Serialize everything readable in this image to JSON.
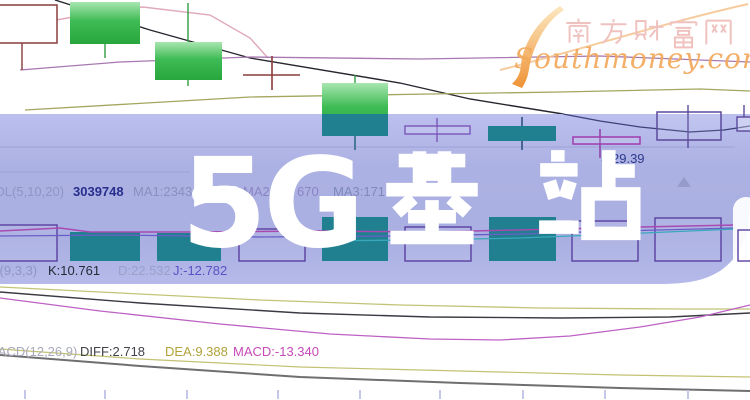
{
  "page": {
    "width": 750,
    "height": 400
  },
  "watermark": {
    "title_prefix": "5G",
    "title_cjk": "基站",
    "full_title": "5G基站"
  },
  "logo": {
    "site_name": "南方财富网",
    "site_url": "Southmoney.com",
    "swoosh_icon": "s-swoosh"
  },
  "indicator_rows": {
    "volume": {
      "label": "VOL(5,10,20)",
      "value": "3039748",
      "ma1": "MA1:2343",
      "ma2": "MA2:2",
      "ma2_cont": "670",
      "ma3": "MA3:171",
      "ma3_cont": "4"
    },
    "kdj": {
      "label": "KDJ(9,3,3)",
      "k": "K:10.761",
      "d": "D:22.532",
      "j": "J:-12.782"
    },
    "macd": {
      "label": "MACD(12,26,9)",
      "diff": "DIFF:2.718",
      "dea": "DEA:9.388",
      "macd": "MACD:-13.340"
    }
  },
  "annotation": {
    "arrow_icon": "←",
    "price": "29.39"
  },
  "colors": {
    "band": "#a9aee2",
    "candle_green": "#2fae44",
    "candle_teal": "#20808f",
    "hollow_purple": "#5a3fa0",
    "maroon": "#8a3c3c",
    "magenta_value": "#c74ab8",
    "dea_olive": "#b2a33c",
    "navy_text": "#272e8c",
    "logo_pink": "#f0c2bf",
    "logo_orange": "#f2a95c"
  },
  "chart_data": {
    "type": "candlestick",
    "title": "5G基站 (watermark over stock K-line chart)",
    "panes": [
      "price with MA lines",
      "volume",
      "KDJ",
      "MACD"
    ],
    "legend": [
      "VOL(5,10,20)",
      "MA1",
      "MA2",
      "MA3",
      "KDJ(9,3,3)",
      "MACD(12,26,9)"
    ],
    "readable_values": {
      "volume": 3039748,
      "MA1": 2343,
      "K": 10.761,
      "D": 22.532,
      "J": -12.782,
      "DIFF": 2.718,
      "DEA": 9.388,
      "MACD": -13.34,
      "price_annotation": 29.39
    },
    "candles_qualitative": [
      {
        "pos": 1,
        "style": "hollow-maroon"
      },
      {
        "pos": 2,
        "style": "solid-green"
      },
      {
        "pos": 3,
        "style": "solid-green"
      },
      {
        "pos": 4,
        "style": "doji-cross-maroon"
      },
      {
        "pos": 5,
        "style": "solid-green"
      },
      {
        "pos": 6,
        "style": "doji-purple"
      },
      {
        "pos": 7,
        "style": "solid-green-under-band"
      },
      {
        "pos": 8,
        "style": "doji-magenta",
        "close": 29.39
      },
      {
        "pos": 9,
        "style": "hollow-purple"
      },
      {
        "pos": 10,
        "style": "hollow-purple-partial"
      }
    ],
    "render": {
      "ops": [
        {
          "op": "poly",
          "name": "price-line-dark",
          "c": "#26262e",
          "w": 1.4,
          "pts": [
            [
              55,
              0
            ],
            [
              150,
              30
            ],
            [
              250,
              58
            ],
            [
              400,
              83
            ],
            [
              470,
              99
            ],
            [
              563,
              114
            ]
          ]
        },
        {
          "op": "poly",
          "name": "ma-line-pink",
          "c": "#e0a8bc",
          "w": 1.4,
          "pts": [
            [
              0,
              30
            ],
            [
              90,
              14
            ],
            [
              143,
              7
            ],
            [
              210,
              15
            ],
            [
              250,
              38
            ],
            [
              268,
              58
            ]
          ]
        },
        {
          "op": "poly",
          "name": "ma-line-purple",
          "c": "#a878b0",
          "w": 1.3,
          "pts": [
            [
              20,
              70
            ],
            [
              120,
              62
            ],
            [
              250,
              57
            ],
            [
              420,
              59
            ],
            [
              600,
              56
            ],
            [
              750,
              62
            ]
          ]
        },
        {
          "op": "poly",
          "name": "ma-line-olive",
          "c": "#a2a65e",
          "w": 1.3,
          "pts": [
            [
              25,
              110
            ],
            [
              250,
              97
            ],
            [
              430,
              94
            ],
            [
              560,
              92
            ],
            [
              700,
              89
            ],
            [
              750,
              91
            ]
          ]
        },
        {
          "op": "rect",
          "name": "candle-hollow",
          "x": -12,
          "y": 5,
          "wd": 69,
          "ht": 38,
          "s": "#8a3c3c",
          "w": 1.5,
          "f": "#ffffff"
        },
        {
          "op": "line",
          "name": "candle-wick",
          "x1": 22,
          "y1": 43,
          "x2": 22,
          "y2": 70,
          "c": "#8a3c3c",
          "w": 1.4
        },
        {
          "op": "rect",
          "name": "candle-green",
          "x": 70,
          "y": 2,
          "wd": 70,
          "ht": 42,
          "f": "url(#greenGrad)"
        },
        {
          "op": "line",
          "name": "candle-wick",
          "x1": 105,
          "y1": 44,
          "x2": 105,
          "y2": 58,
          "c": "#2f9c42",
          "w": 1.4
        },
        {
          "op": "rect",
          "name": "candle-green",
          "x": 155,
          "y": 42,
          "wd": 67,
          "ht": 38,
          "f": "url(#greenGrad)"
        },
        {
          "op": "line",
          "name": "candle-wick",
          "x1": 188,
          "y1": 3,
          "x2": 188,
          "y2": 42,
          "c": "#2f9c42",
          "w": 1.4
        },
        {
          "op": "line",
          "name": "candle-wick",
          "x1": 188,
          "y1": 80,
          "x2": 188,
          "y2": 86,
          "c": "#2f9c42",
          "w": 1.4
        },
        {
          "op": "line",
          "name": "doji-cross-v",
          "x1": 272,
          "y1": 56,
          "x2": 272,
          "y2": 90,
          "c": "#8a3c3c",
          "w": 1.6
        },
        {
          "op": "line",
          "name": "doji-cross-h",
          "x1": 243,
          "y1": 75,
          "x2": 300,
          "y2": 75,
          "c": "#8a3c3c",
          "w": 1.6
        },
        {
          "op": "rect",
          "name": "candle-green",
          "x": 322,
          "y": 83,
          "wd": 66,
          "ht": 53,
          "f": "url(#greenGrad)"
        },
        {
          "op": "line",
          "name": "candle-wick",
          "x1": 355,
          "y1": 75,
          "x2": 355,
          "y2": 83,
          "c": "#2f9c42",
          "w": 1.4
        },
        {
          "op": "path",
          "name": "watermark-band",
          "d": "M-10,114 L750,114 L750,198 C750,232 744,254 720,271 C704,281 686,284 658,284 L-10,284 Z",
          "f": "url(#bandGrad)",
          "o": 0.96
        },
        {
          "op": "poly",
          "name": "grid-line",
          "c": "#9aa0d2",
          "w": 1,
          "o": 0.9,
          "pts": [
            [
              0,
              147
            ],
            [
              735,
              147
            ]
          ]
        },
        {
          "op": "poly",
          "name": "grid-line",
          "c": "#9aa0d2",
          "w": 1,
          "o": 0.8,
          "pts": [
            [
              0,
              172
            ],
            [
              190,
              172
            ]
          ]
        },
        {
          "op": "poly",
          "name": "price-line-in-band",
          "c": "#3a4278",
          "w": 1.3,
          "pts": [
            [
              563,
              114
            ],
            [
              600,
              121
            ],
            [
              640,
              127
            ],
            [
              690,
              132
            ],
            [
              724,
              130
            ],
            [
              750,
              126
            ]
          ]
        },
        {
          "op": "rect",
          "name": "volume-bar-hollow",
          "x": -8,
          "y": 225,
          "wd": 65,
          "ht": 36,
          "s": "#5a3fa0",
          "w": 1.4,
          "f": "rgba(255,255,255,0.07)"
        },
        {
          "op": "rect",
          "name": "volume-bar",
          "x": 70,
          "y": 232,
          "wd": 70,
          "ht": 29,
          "f": "#20808f"
        },
        {
          "op": "rect",
          "name": "volume-bar",
          "x": 157,
          "y": 233,
          "wd": 64,
          "ht": 28,
          "f": "#20808f"
        },
        {
          "op": "rect",
          "name": "volume-bar-hollow",
          "x": 239,
          "y": 229,
          "wd": 66,
          "ht": 32,
          "s": "#5a3fa0",
          "w": 1.4,
          "f": "rgba(255,255,255,0.07)"
        },
        {
          "op": "rect",
          "name": "volume-bar",
          "x": 322,
          "y": 217,
          "wd": 66,
          "ht": 44,
          "f": "#20808f"
        },
        {
          "op": "rect",
          "name": "volume-bar-hollow",
          "x": 405,
          "y": 227,
          "wd": 66,
          "ht": 34,
          "s": "#5a3fa0",
          "w": 1.4,
          "f": "rgba(255,255,255,0.07)"
        },
        {
          "op": "rect",
          "name": "volume-bar",
          "x": 489,
          "y": 217,
          "wd": 67,
          "ht": 44,
          "f": "#20808f"
        },
        {
          "op": "rect",
          "name": "volume-bar-hollow",
          "x": 572,
          "y": 221,
          "wd": 66,
          "ht": 40,
          "s": "#5a3fa0",
          "w": 1.4,
          "f": "rgba(255,255,255,0.07)"
        },
        {
          "op": "rect",
          "name": "volume-bar-hollow",
          "x": 655,
          "y": 218,
          "wd": 66,
          "ht": 43,
          "s": "#5a3fa0",
          "w": 1.4,
          "f": "rgba(255,255,255,0.07)"
        },
        {
          "op": "rect",
          "name": "candle-teal",
          "x": 322,
          "y": 114,
          "wd": 66,
          "ht": 22,
          "f": "#20808f"
        },
        {
          "op": "line",
          "name": "candle-wick",
          "x1": 355,
          "y1": 136,
          "x2": 355,
          "y2": 150,
          "c": "#1e5f74",
          "w": 1.4
        },
        {
          "op": "line",
          "name": "candle-wick",
          "x1": 437,
          "y1": 118,
          "x2": 437,
          "y2": 142,
          "c": "#7a55b8",
          "w": 1.4
        },
        {
          "op": "rect",
          "name": "candle-doji",
          "x": 405,
          "y": 126,
          "wd": 65,
          "ht": 8,
          "s": "#7a55b8",
          "w": 1.4,
          "f": "rgba(255,255,255,0.12)"
        },
        {
          "op": "line",
          "name": "candle-wick",
          "x1": 522,
          "y1": 117,
          "x2": 522,
          "y2": 150,
          "c": "#254a78",
          "w": 1.5
        },
        {
          "op": "rect",
          "name": "candle-teal",
          "x": 488,
          "y": 126,
          "wd": 68,
          "ht": 15,
          "f": "#20808f"
        },
        {
          "op": "line",
          "name": "candle-wick",
          "x1": 600,
          "y1": 129,
          "x2": 600,
          "y2": 158,
          "c": "#8a35a0",
          "w": 1.4
        },
        {
          "op": "rect",
          "name": "candle-doji",
          "x": 573,
          "y": 137,
          "wd": 67,
          "ht": 7,
          "s": "#a03cae",
          "w": 1.5,
          "f": "rgba(255,255,255,0.12)"
        },
        {
          "op": "line",
          "name": "candle-wick",
          "x1": 688,
          "y1": 105,
          "x2": 688,
          "y2": 148,
          "c": "#5b4a9b",
          "w": 1.4
        },
        {
          "op": "rect",
          "name": "candle-hollow",
          "x": 657,
          "y": 112,
          "wd": 64,
          "ht": 28,
          "s": "#5b4a9b",
          "w": 1.5,
          "f": "rgba(255,255,255,0.08)"
        },
        {
          "op": "poly",
          "name": "indicator-line-magenta",
          "c": "#a84ab2",
          "w": 1.5,
          "pts": [
            [
              0,
              231
            ],
            [
              60,
              228
            ],
            [
              90,
              232
            ],
            [
              200,
              232
            ],
            [
              320,
              231
            ],
            [
              430,
              232
            ],
            [
              560,
              229
            ],
            [
              640,
              227
            ],
            [
              736,
              225
            ]
          ]
        },
        {
          "op": "poly",
          "name": "indicator-line-violet",
          "c": "#6a5ec6",
          "w": 1.3,
          "pts": [
            [
              0,
              236
            ],
            [
              120,
              235
            ],
            [
              260,
              237
            ],
            [
              400,
              236
            ],
            [
              520,
              234
            ],
            [
              620,
              231
            ],
            [
              736,
              228
            ]
          ]
        },
        {
          "op": "poly",
          "name": "indicator-line-cyan",
          "c": "#3aa8bc",
          "w": 1.3,
          "pts": [
            [
              300,
              241
            ],
            [
              420,
              240
            ],
            [
              520,
              238
            ],
            [
              620,
              234
            ],
            [
              736,
              229
            ]
          ]
        },
        {
          "op": "rect",
          "name": "band-corner-highlight",
          "x": 733,
          "y": 197,
          "wd": 26,
          "ht": 82,
          "rx": 13,
          "f": "#ffffff",
          "o": 0.93
        },
        {
          "op": "rect",
          "name": "volume-bar-hollow",
          "x": 738,
          "y": 230,
          "wd": 18,
          "ht": 31,
          "s": "#5a3fa0",
          "w": 1.4,
          "f": "rgba(255,255,255,0.2)"
        },
        {
          "op": "rect",
          "name": "candle-hollow",
          "x": 737,
          "y": 117,
          "wd": 18,
          "ht": 14,
          "s": "#5b4a9b",
          "w": 1.4,
          "f": "rgba(255,255,255,0.3)"
        },
        {
          "op": "line",
          "name": "candle-wick",
          "x1": 744,
          "y1": 105,
          "x2": 744,
          "y2": 117,
          "c": "#5b4a9b",
          "w": 1.4
        },
        {
          "op": "polygon",
          "name": "marker-triangle-up",
          "ptsStr": "684,177 691,187 677,187",
          "f": "#9198c6",
          "o": 0.85
        },
        {
          "op": "poly",
          "name": "kdj-line-d",
          "c": "#c2c478",
          "w": 1.3,
          "pts": [
            [
              0,
              287
            ],
            [
              120,
              293
            ],
            [
              260,
              300
            ],
            [
              400,
              305
            ],
            [
              540,
              308
            ],
            [
              680,
              309
            ],
            [
              750,
              309
            ]
          ]
        },
        {
          "op": "poly",
          "name": "kdj-line-k",
          "c": "#3a3a42",
          "w": 1.4,
          "pts": [
            [
              0,
              292
            ],
            [
              140,
              303
            ],
            [
              300,
              313
            ],
            [
              430,
              317
            ],
            [
              560,
              318
            ],
            [
              670,
              317
            ],
            [
              750,
              313
            ]
          ]
        },
        {
          "op": "poly",
          "name": "kdj-line-j",
          "c": "#bd62c4",
          "w": 1.3,
          "pts": [
            [
              0,
              298
            ],
            [
              100,
              311
            ],
            [
              220,
              324
            ],
            [
              330,
              334
            ],
            [
              430,
              339
            ],
            [
              500,
              340
            ],
            [
              570,
              336
            ],
            [
              640,
              327
            ],
            [
              700,
              317
            ],
            [
              750,
              305
            ]
          ]
        },
        {
          "op": "poly",
          "name": "macd-line-dea",
          "c": "#c2c272",
          "w": 1.2,
          "pts": [
            [
              0,
              349
            ],
            [
              140,
              359
            ],
            [
              300,
              367
            ],
            [
              460,
              371
            ],
            [
              620,
              375
            ],
            [
              750,
              377
            ]
          ]
        },
        {
          "op": "poly",
          "name": "macd-line-diff",
          "c": "#6f6f72",
          "w": 2,
          "pts": [
            [
              0,
              355
            ],
            [
              140,
              366
            ],
            [
              300,
              377
            ],
            [
              460,
              383
            ],
            [
              620,
              388
            ],
            [
              750,
              391
            ]
          ]
        },
        {
          "op": "ticks",
          "name": "histogram-tick",
          "xs": [
            25,
            105,
            187,
            278,
            360,
            440,
            523,
            605,
            688
          ],
          "y1": 390,
          "y2": 399,
          "c": "#c6c8e8",
          "w": 2
        }
      ]
    }
  }
}
